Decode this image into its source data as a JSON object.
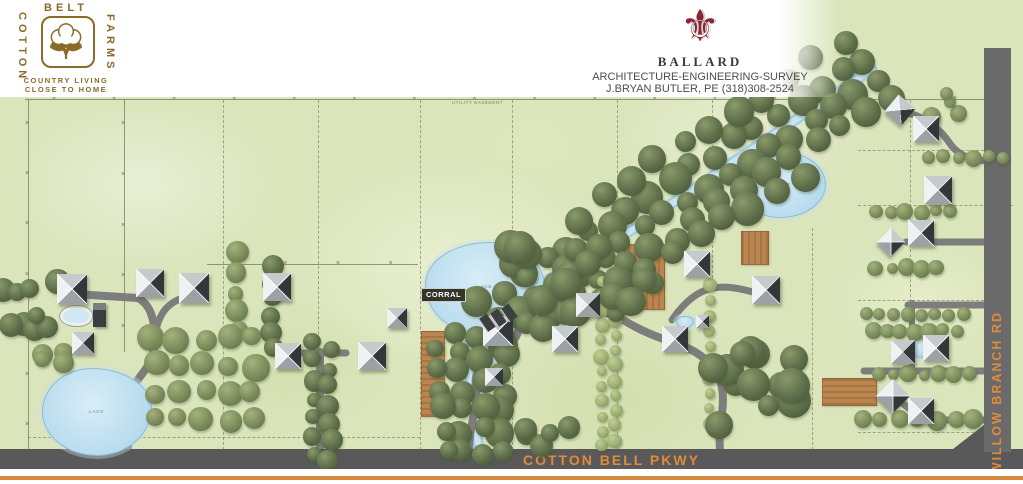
{
  "header": {
    "cotton_logo": {
      "word_top": "BELT",
      "word_left": "COTTON",
      "word_right": "FARMS",
      "tagline_line1": "COUNTRY LIVING",
      "tagline_line2": "CLOSE TO HOME"
    },
    "ballard_logo": {
      "fleur_glyph": "⚜",
      "name": "BALLARD",
      "services": "ARCHITECTURE-ENGINEERING-SURVEY",
      "contact": "J.BRYAN BUTLER, PE (318)308-2524"
    }
  },
  "map": {
    "road_labels": {
      "bottom": "COTTON BELL PKWY",
      "right": "WILLOW BRANCH RD"
    },
    "annotations": {
      "corral": "CORRAL",
      "lake": "LAKE",
      "easement": "UTILITY EASEMENT"
    },
    "colors": {
      "grass": "#dbe5bc",
      "driveway": "#7d7d7d",
      "parkway": "#595959",
      "willow_road": "#6a6a6a",
      "road_text": "#de8c3c",
      "orange_line": "#d4883b",
      "water": "#bcdeef",
      "field": "#b98551",
      "field_stripe": "#a9743f",
      "tree_dark": "#5e6e4a",
      "tree_medium": "#7b8c5c",
      "tree_light": "#9cae72",
      "logo_brown": "#8a6b2a",
      "fleur_maroon": "#8c2433"
    },
    "features": {
      "creek_path": "M872,70 C830,95 700,185 640,225 C580,262 525,290 495,315 C472,333 463,345 467,365 C472,392 482,402 478,422 C474,442 482,452 485,460",
      "corner_polygon": "984,425 984,449 953,449",
      "driveways": [
        {
          "d": "M128,458 L128,402 C128,382 152,372 154,348 C156,326 153,306 138,298 L74,294",
          "w": 8
        },
        {
          "d": "M154,340 C158,312 168,298 200,294",
          "w": 7
        },
        {
          "d": "M320,458 L320,352",
          "w": 8
        },
        {
          "d": "M296,353 L346,353",
          "w": 7
        },
        {
          "d": "M470,458 C466,430 479,410 476,388 C473,368 488,356 500,350 C516,343 520,333 519,318 C518,304 534,299 550,302 L585,309",
          "w": 8
        },
        {
          "d": "M721,458 C716,430 726,410 722,388 C718,366 700,352 680,345 C660,338 642,332 620,318 L601,311",
          "w": 8
        },
        {
          "d": "M768,296 C740,288 722,284 706,290 C692,295 680,308 672,320",
          "w": 7
        },
        {
          "d": "M902,112 C925,115 941,130 951,145 C961,158 976,161 992,161",
          "w": 7
        },
        {
          "d": "M906,242 L992,242",
          "w": 7
        },
        {
          "d": "M908,305 L992,305",
          "w": 7
        },
        {
          "d": "M912,303 L912,371",
          "w": 6
        },
        {
          "d": "M864,371 L992,371",
          "w": 7
        },
        {
          "d": "M992,420 L940,420 C918,420 910,408 898,400",
          "w": 7
        },
        {
          "d": "M928,352 L912,352",
          "w": 6
        }
      ],
      "fences": [
        {
          "x1": 25,
          "y1": 99,
          "x2": 986,
          "y2": 99,
          "marks": 16
        },
        {
          "x1": 28,
          "y1": 99,
          "x2": 28,
          "y2": 450,
          "marks": 7
        },
        {
          "x1": 124,
          "y1": 99,
          "x2": 124,
          "y2": 352,
          "marks": 5
        },
        {
          "x1": 207,
          "y1": 264,
          "x2": 418,
          "y2": 264,
          "marks": 4
        }
      ],
      "lot_lines_v": [
        [
          223,
          100,
          450
        ],
        [
          318,
          100,
          450
        ],
        [
          420,
          100,
          450
        ],
        [
          512,
          100,
          450
        ],
        [
          617,
          100,
          450
        ],
        [
          712,
          100,
          278
        ],
        [
          812,
          228,
          450
        ],
        [
          910,
          100,
          302
        ]
      ],
      "lot_lines_h": [
        [
          150,
          858,
          984
        ],
        [
          205,
          858,
          1013
        ],
        [
          300,
          858,
          984
        ],
        [
          432,
          858,
          984
        ],
        [
          437,
          28,
          420
        ]
      ],
      "fields": [
        {
          "x": 421,
          "y": 331,
          "w": 22,
          "h": 84,
          "dir": "h"
        },
        {
          "x": 621,
          "y": 244,
          "w": 42,
          "h": 64,
          "dir": "v"
        },
        {
          "x": 741,
          "y": 231,
          "w": 26,
          "h": 32,
          "dir": "v"
        },
        {
          "x": 822,
          "y": 378,
          "w": 53,
          "h": 26,
          "dir": "h"
        }
      ],
      "lakes": [
        {
          "x": 425,
          "y": 242,
          "w": 118,
          "h": 88,
          "label": true,
          "br": "55% 45% 58% 42% / 48% 52% 45% 55%"
        },
        {
          "x": 742,
          "y": 152,
          "w": 82,
          "h": 64,
          "label": true,
          "br": "50% 50% 55% 45% / 55% 50% 50% 45%"
        },
        {
          "x": 42,
          "y": 368,
          "w": 108,
          "h": 86,
          "label": true,
          "br": "45% 55% 50% 50% / 50% 45% 55% 50%"
        }
      ],
      "ponds": [
        {
          "x": 487,
          "y": 349,
          "w": 22,
          "h": 14
        },
        {
          "x": 676,
          "y": 316,
          "w": 16,
          "h": 10
        },
        {
          "x": 912,
          "y": 339,
          "w": 13,
          "h": 17
        },
        {
          "x": 60,
          "y": 306,
          "w": 26,
          "h": 14,
          "pool": true
        }
      ],
      "tree_rows": [
        {
          "x1": 862,
          "y1": 57,
          "x2": 480,
          "y2": 303,
          "n": 19,
          "r": 13,
          "c": "dark",
          "j": 10
        },
        {
          "x1": 877,
          "y1": 80,
          "x2": 495,
          "y2": 326,
          "n": 19,
          "r": 13,
          "c": "dark",
          "j": 10
        },
        {
          "x1": 888,
          "y1": 97,
          "x2": 506,
          "y2": 343,
          "n": 17,
          "r": 12,
          "c": "dark",
          "j": 10
        },
        {
          "x1": 800,
          "y1": 175,
          "x2": 545,
          "y2": 330,
          "n": 11,
          "r": 13,
          "c": "dark",
          "j": 12
        },
        {
          "x1": 840,
          "y1": 45,
          "x2": 580,
          "y2": 215,
          "n": 11,
          "r": 12,
          "c": "dark",
          "j": 12
        },
        {
          "x1": 458,
          "y1": 332,
          "x2": 462,
          "y2": 452,
          "n": 7,
          "r": 12,
          "c": "dark",
          "j": 8
        },
        {
          "x1": 503,
          "y1": 337,
          "x2": 501,
          "y2": 452,
          "n": 7,
          "r": 12,
          "c": "dark",
          "j": 8
        },
        {
          "x1": 437,
          "y1": 347,
          "x2": 446,
          "y2": 448,
          "n": 6,
          "r": 11,
          "c": "dark",
          "j": 8
        },
        {
          "x1": 480,
          "y1": 335,
          "x2": 484,
          "y2": 455,
          "n": 6,
          "r": 12,
          "c": "dark",
          "j": 8
        },
        {
          "x1": 272,
          "y1": 266,
          "x2": 272,
          "y2": 348,
          "n": 6,
          "r": 9,
          "c": "dark",
          "j": 5
        },
        {
          "x1": 314,
          "y1": 340,
          "x2": 314,
          "y2": 456,
          "n": 7,
          "r": 9,
          "c": "dark",
          "j": 5
        },
        {
          "x1": 330,
          "y1": 350,
          "x2": 330,
          "y2": 458,
          "n": 7,
          "r": 9,
          "c": "dark",
          "j": 5
        },
        {
          "x1": 237,
          "y1": 253,
          "x2": 237,
          "y2": 330,
          "n": 5,
          "r": 10,
          "c": "med",
          "j": 5
        },
        {
          "x1": 602,
          "y1": 281,
          "x2": 602,
          "y2": 446,
          "n": 12,
          "r": 6.5,
          "c": "light",
          "j": 3
        },
        {
          "x1": 615,
          "y1": 289,
          "x2": 615,
          "y2": 441,
          "n": 11,
          "r": 6.5,
          "c": "light",
          "j": 3
        },
        {
          "x1": 710,
          "y1": 286,
          "x2": 710,
          "y2": 424,
          "n": 10,
          "r": 6.5,
          "c": "light",
          "j": 3
        },
        {
          "x1": 928,
          "y1": 157,
          "x2": 1003,
          "y2": 157,
          "n": 6,
          "r": 7,
          "c": "med",
          "j": 3
        },
        {
          "x1": 876,
          "y1": 212,
          "x2": 951,
          "y2": 212,
          "n": 6,
          "r": 7,
          "c": "med",
          "j": 3
        },
        {
          "x1": 876,
          "y1": 268,
          "x2": 936,
          "y2": 268,
          "n": 5,
          "r": 7,
          "c": "med",
          "j": 3
        },
        {
          "x1": 866,
          "y1": 315,
          "x2": 964,
          "y2": 315,
          "n": 8,
          "r": 7,
          "c": "med",
          "j": 3
        },
        {
          "x1": 873,
          "y1": 331,
          "x2": 957,
          "y2": 331,
          "n": 7,
          "r": 7,
          "c": "med",
          "j": 3
        },
        {
          "x1": 880,
          "y1": 374,
          "x2": 968,
          "y2": 374,
          "n": 7,
          "r": 7,
          "c": "med",
          "j": 3
        },
        {
          "x1": 862,
          "y1": 420,
          "x2": 974,
          "y2": 420,
          "n": 7,
          "r": 9,
          "c": "med",
          "j": 3
        }
      ],
      "tree_grids": [
        {
          "x": 153,
          "y": 340,
          "cols": 5,
          "rows": 4,
          "dx": 25,
          "dy": 26,
          "r": 11,
          "c": "med"
        }
      ],
      "tree_blobs": [
        {
          "x": 572,
          "y": 278,
          "n": 10,
          "spread": 42,
          "r": 13,
          "c": "dark"
        },
        {
          "x": 636,
          "y": 302,
          "n": 6,
          "spread": 30,
          "r": 12,
          "c": "dark"
        },
        {
          "x": 760,
          "y": 395,
          "n": 13,
          "spread": 55,
          "r": 14,
          "c": "dark"
        },
        {
          "x": 545,
          "y": 428,
          "n": 5,
          "spread": 26,
          "r": 12,
          "c": "dark"
        },
        {
          "x": 520,
          "y": 258,
          "n": 5,
          "spread": 25,
          "r": 13,
          "c": "dark"
        },
        {
          "x": 28,
          "y": 305,
          "n": 9,
          "spread": 40,
          "r": 10,
          "c": "dark"
        },
        {
          "x": 55,
          "y": 370,
          "n": 4,
          "spread": 20,
          "r": 9,
          "c": "med"
        },
        {
          "x": 938,
          "y": 112,
          "n": 5,
          "spread": 24,
          "r": 8,
          "c": "med"
        }
      ],
      "buildings": [
        [
          72,
          289,
          30,
          0
        ],
        [
          83,
          343,
          22,
          0
        ],
        [
          150,
          283,
          28,
          0
        ],
        [
          194,
          288,
          30,
          0
        ],
        [
          277,
          287,
          28,
          0
        ],
        [
          288,
          356,
          26,
          0
        ],
        [
          372,
          356,
          28,
          0
        ],
        [
          397,
          318,
          20,
          0
        ],
        [
          498,
          331,
          30,
          0
        ],
        [
          494,
          377,
          18,
          0
        ],
        [
          565,
          339,
          26,
          0
        ],
        [
          588,
          305,
          24,
          0
        ],
        [
          675,
          339,
          26,
          0
        ],
        [
          697,
          264,
          26,
          0
        ],
        [
          702,
          321,
          13,
          0
        ],
        [
          766,
          290,
          28,
          0
        ],
        [
          900,
          110,
          22,
          40
        ],
        [
          926,
          129,
          26,
          0
        ],
        [
          938,
          190,
          28,
          0
        ],
        [
          921,
          233,
          26,
          0
        ],
        [
          891,
          242,
          20,
          45
        ],
        [
          903,
          352,
          24,
          0
        ],
        [
          936,
          348,
          26,
          0
        ],
        [
          893,
          396,
          24,
          45
        ],
        [
          921,
          411,
          26,
          0
        ]
      ],
      "outbuildings": [
        [
          99,
          315,
          13,
          24
        ]
      ],
      "parking_stalls": [
        [
          486,
          323,
          -35
        ],
        [
          497,
          318,
          -35
        ],
        [
          508,
          313,
          -35
        ]
      ]
    }
  }
}
